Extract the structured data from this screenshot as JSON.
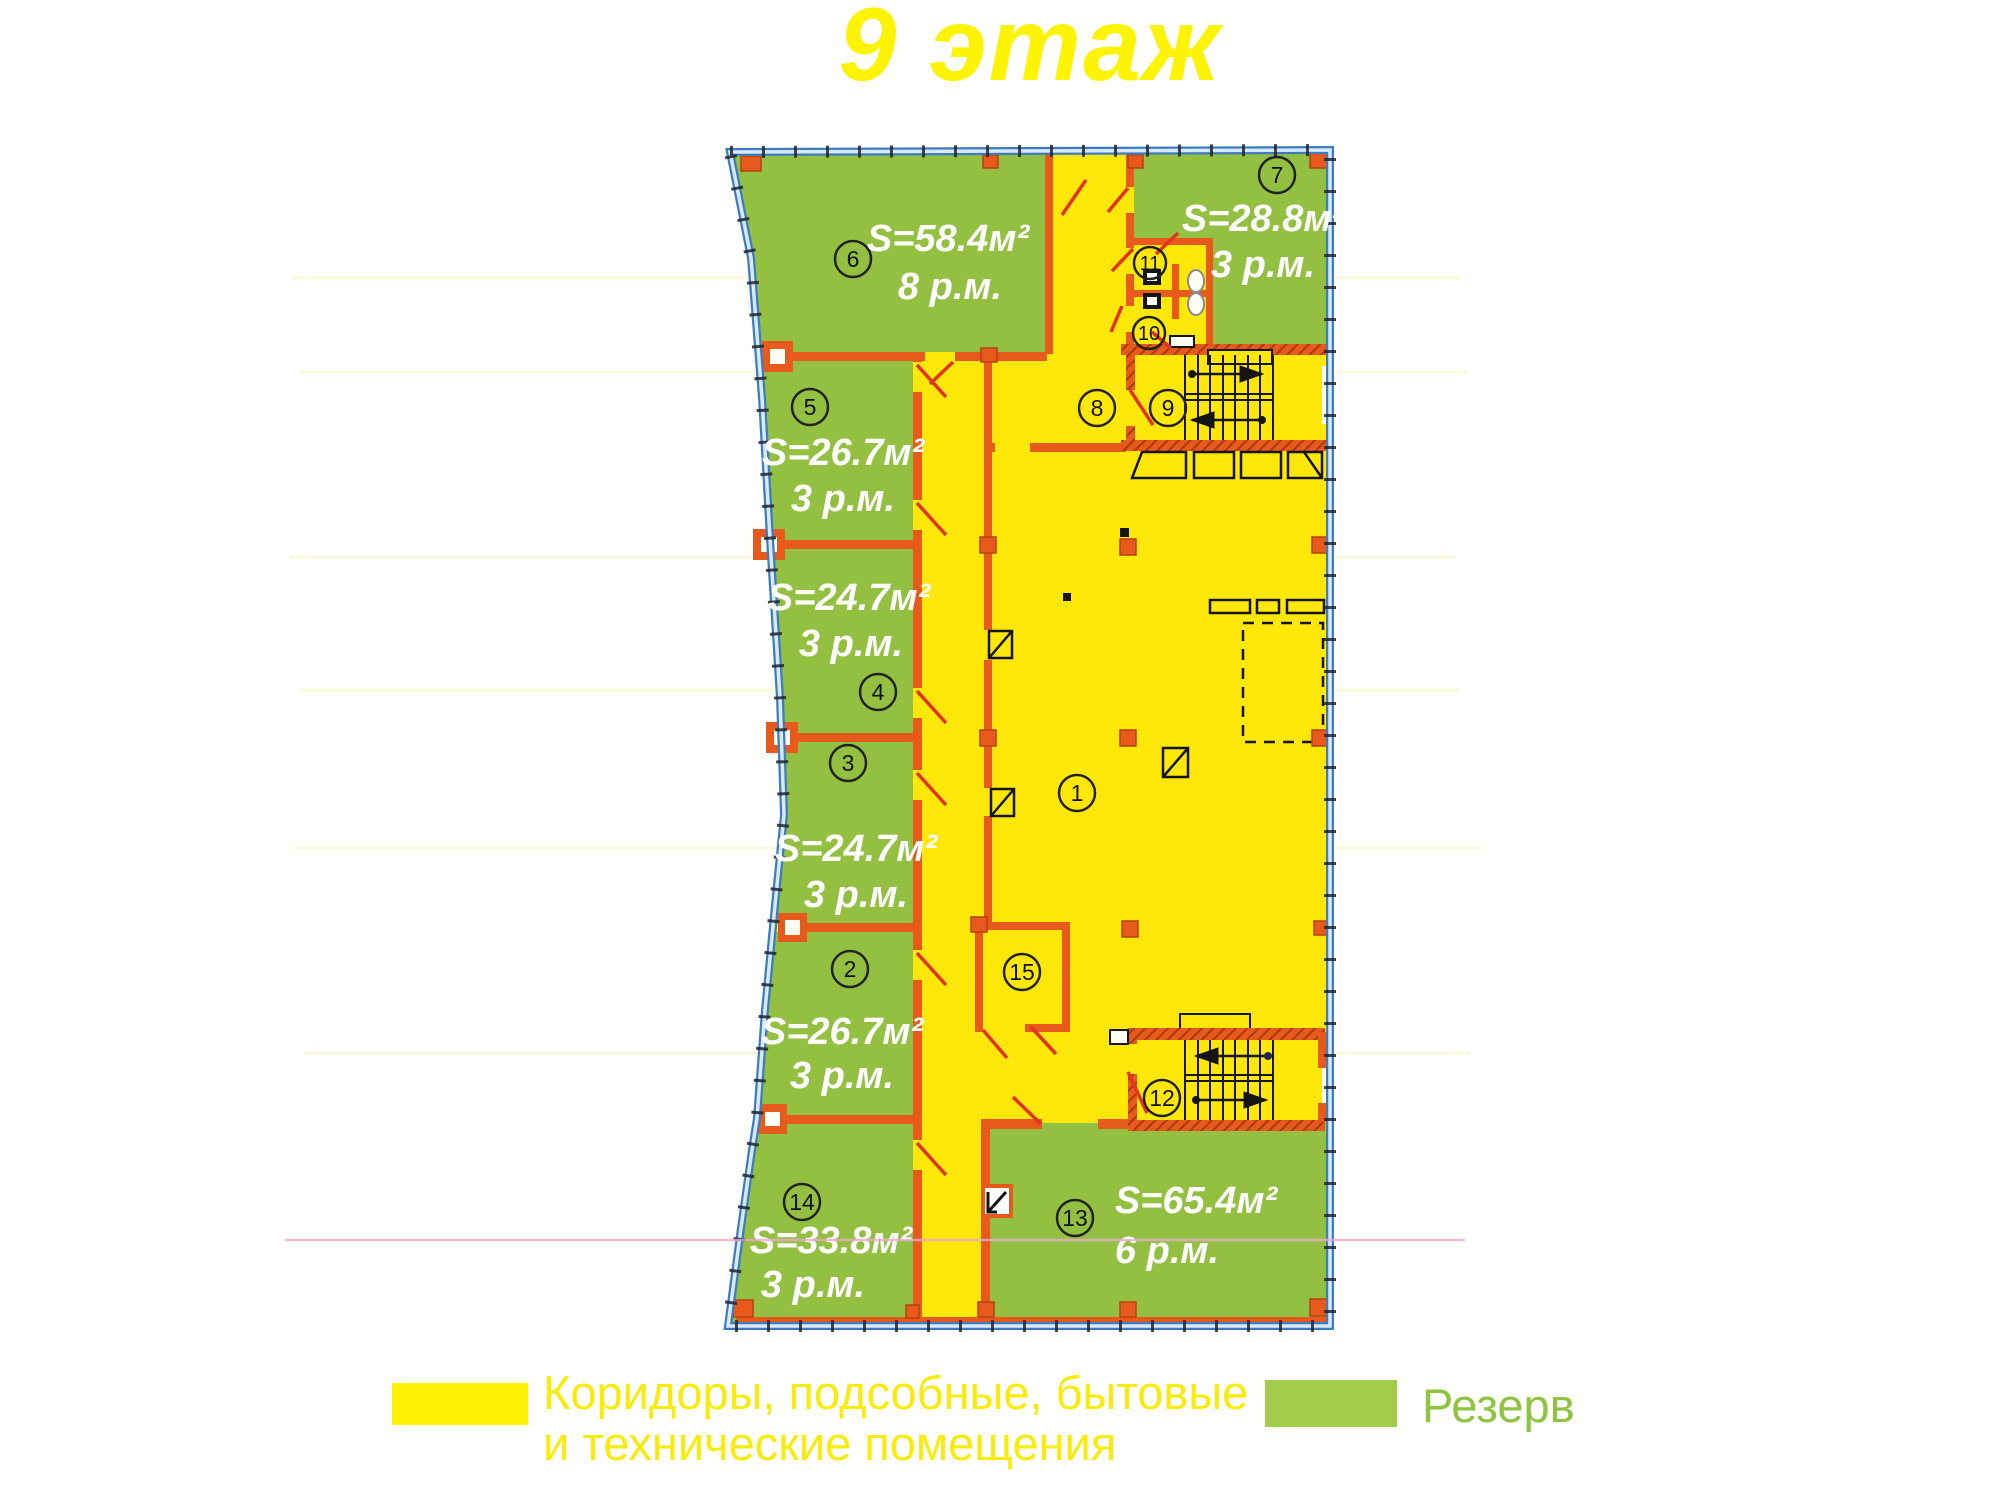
{
  "title": {
    "text": "9 этаж"
  },
  "legend": {
    "corridor_line1": "Коридоры, подсобные, бытовые",
    "corridor_line2": "и технические помещения",
    "reserve_label": "Резерв"
  },
  "colors": {
    "corridor": "#ffe70a",
    "reserve": "#93c041",
    "legend_corridor_swatch": "#fdf105",
    "legend_reserve_swatch": "#a3cc4b",
    "walls": "#e8591c",
    "boundary": "#3e7cc2",
    "door_swing": "#e23222",
    "title": "#fdf304"
  },
  "rooms": {
    "r1": {
      "number": "1"
    },
    "r2": {
      "number": "2",
      "area": "S=26.7м²",
      "places": "3 р.м."
    },
    "r3": {
      "number": "3",
      "area": "S=24.7м²",
      "places": "3 р.м."
    },
    "r4": {
      "number": "4",
      "area": "S=24.7м²",
      "places": "3 р.м."
    },
    "r5": {
      "number": "5",
      "area": "S=26.7м²",
      "places": "3 р.м."
    },
    "r6": {
      "number": "6",
      "area": "S=58.4м²",
      "places": "8 р.м."
    },
    "r7": {
      "number": "7",
      "area": "S=28.8м²",
      "places": "3 р.м."
    },
    "r8": {
      "number": "8"
    },
    "r9": {
      "number": "9"
    },
    "r10": {
      "number": "10"
    },
    "r11": {
      "number": "11"
    },
    "r12": {
      "number": "12"
    },
    "r13": {
      "number": "13",
      "area": "S=65.4м²",
      "places": "6 р.м."
    },
    "r14": {
      "number": "14",
      "area": "S=33.8м²",
      "places": "3 р.м."
    },
    "r15": {
      "number": "15"
    }
  }
}
